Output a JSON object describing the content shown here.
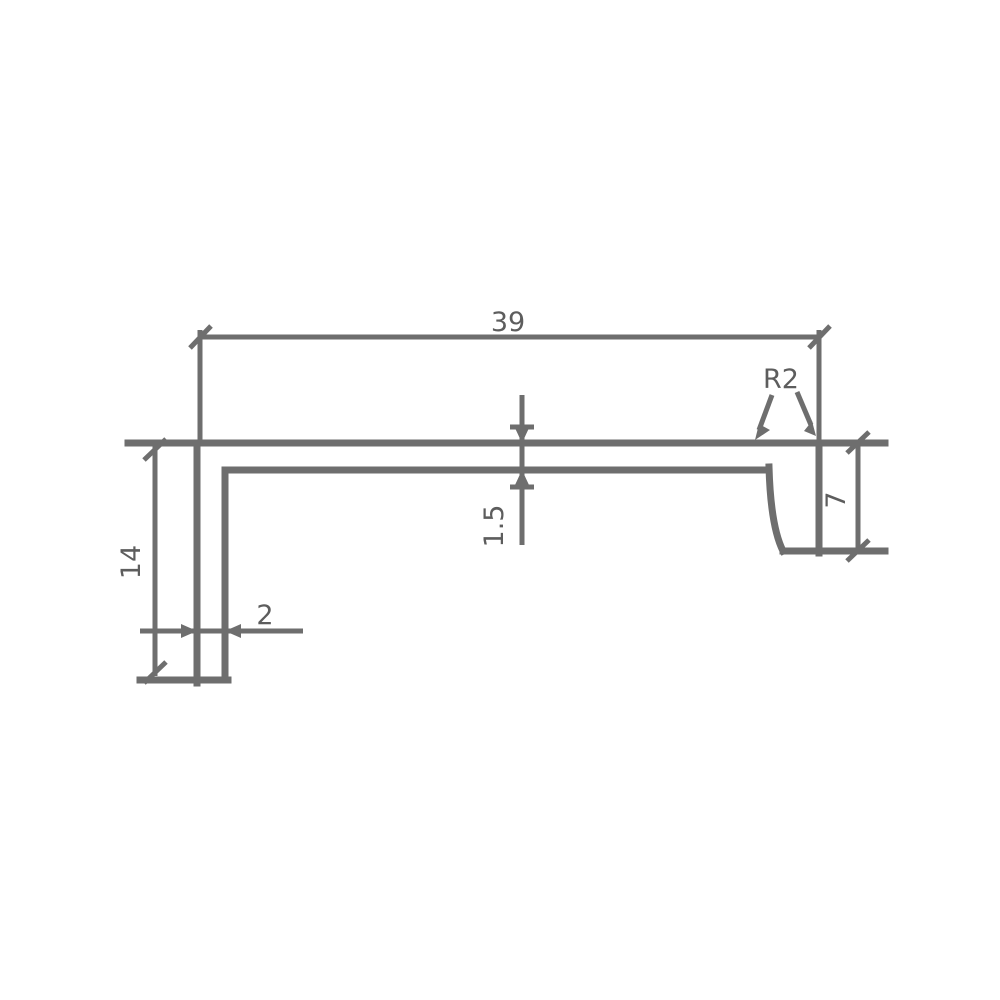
{
  "drawing": {
    "kind": "technical-profile-cross-section",
    "background_color": "#ffffff",
    "line_color": "#6e6e6e",
    "text_color": "#5d5d5d",
    "labels": {
      "overall_width": "39",
      "left_flange_height": "14",
      "foot_thickness": "2",
      "web_thickness": "1.5",
      "right_flange_height": "7",
      "corner_radius": "R2"
    }
  }
}
